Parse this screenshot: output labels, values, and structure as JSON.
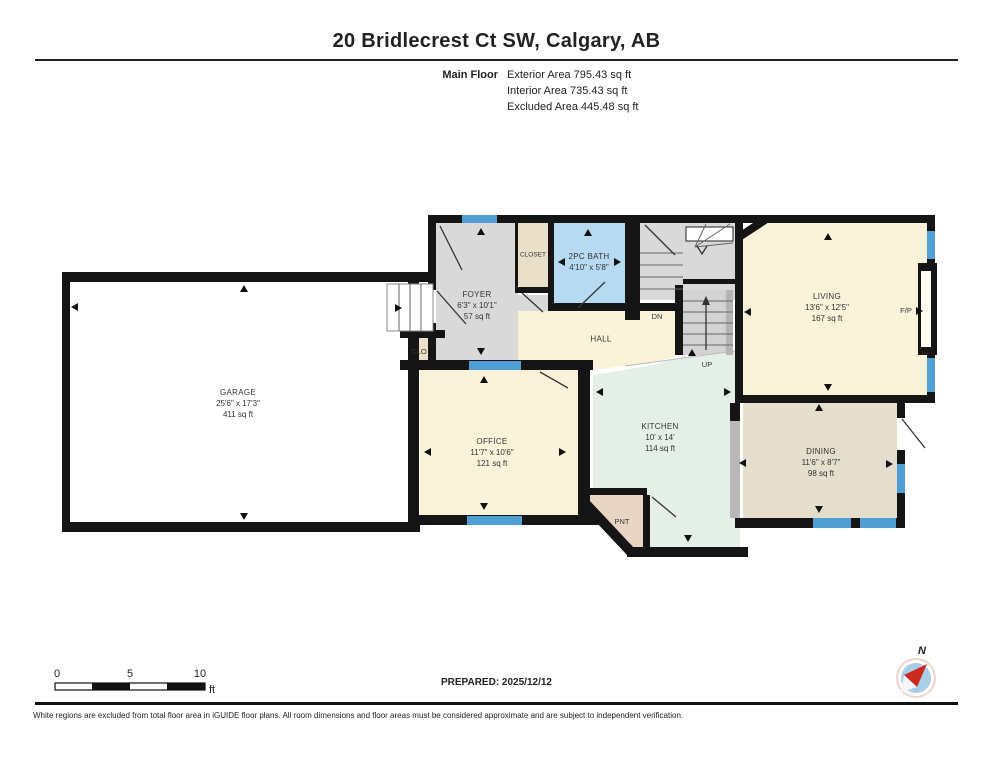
{
  "header": {
    "title": "20 Bridlecrest Ct SW, Calgary, AB",
    "floor_label": "Main Floor",
    "areas": [
      {
        "name": "Exterior Area",
        "value": "795.43 sq ft"
      },
      {
        "name": "Interior Area",
        "value": "735.43 sq ft"
      },
      {
        "name": "Excluded Area",
        "value": "445.48 sq ft"
      }
    ]
  },
  "rooms": {
    "garage": {
      "name": "GARAGE",
      "dims": "25'6\" x 17'3\"",
      "area": "411 sq ft"
    },
    "foyer": {
      "name": "FOYER",
      "dims": "6'3\" x 10'1\"",
      "area": "57 sq ft"
    },
    "closet": {
      "name": "CLOSET"
    },
    "bath": {
      "name": "2PC BATH",
      "dims": "4'10\" x 5'8\""
    },
    "hall": {
      "name": "HALL"
    },
    "living": {
      "name": "LIVING",
      "dims": "13'6\" x 12'5\"",
      "area": "167 sq ft"
    },
    "office": {
      "name": "OFFICE",
      "dims": "11'7\" x 10'6\"",
      "area": "121 sq ft"
    },
    "kitchen": {
      "name": "KITCHEN",
      "dims": "10' x 14'",
      "area": "114 sq ft"
    },
    "dining": {
      "name": "DINING",
      "dims": "11'6\" x 8'7\"",
      "area": "98 sq ft"
    },
    "pantry": {
      "name": "PNT"
    },
    "clo": {
      "name": "CLO"
    },
    "fireplace": {
      "name": "F/P"
    },
    "stairs_down": {
      "name": "DN"
    },
    "stairs_up": {
      "name": "UP"
    }
  },
  "scale_bar": {
    "ticks": [
      "0",
      "5",
      "10"
    ],
    "unit": "ft"
  },
  "footer": {
    "prepared": "PREPARED: 2025/12/12",
    "disclaimer": "White regions are excluded from total floor area in iGUIDE floor plans. All room dimensions and floor areas must be considered approximate and are subject to independent verification.",
    "compass_north": "N"
  },
  "colors": {
    "wall": "#151515",
    "room_cream": "#faf3d9",
    "room_gray": "#d9d9d9",
    "stair_gray": "#d3d3d3",
    "room_blue": "#b5daf2",
    "room_mint": "#e4efe8",
    "room_tan": "#e5decd",
    "room_beige": "#eadfc9",
    "room_pantry": "#e8d5c4",
    "window_blue": "#4f9fd4",
    "compass_red": "#cc2a1e",
    "compass_blue": "#a8cfe8"
  }
}
